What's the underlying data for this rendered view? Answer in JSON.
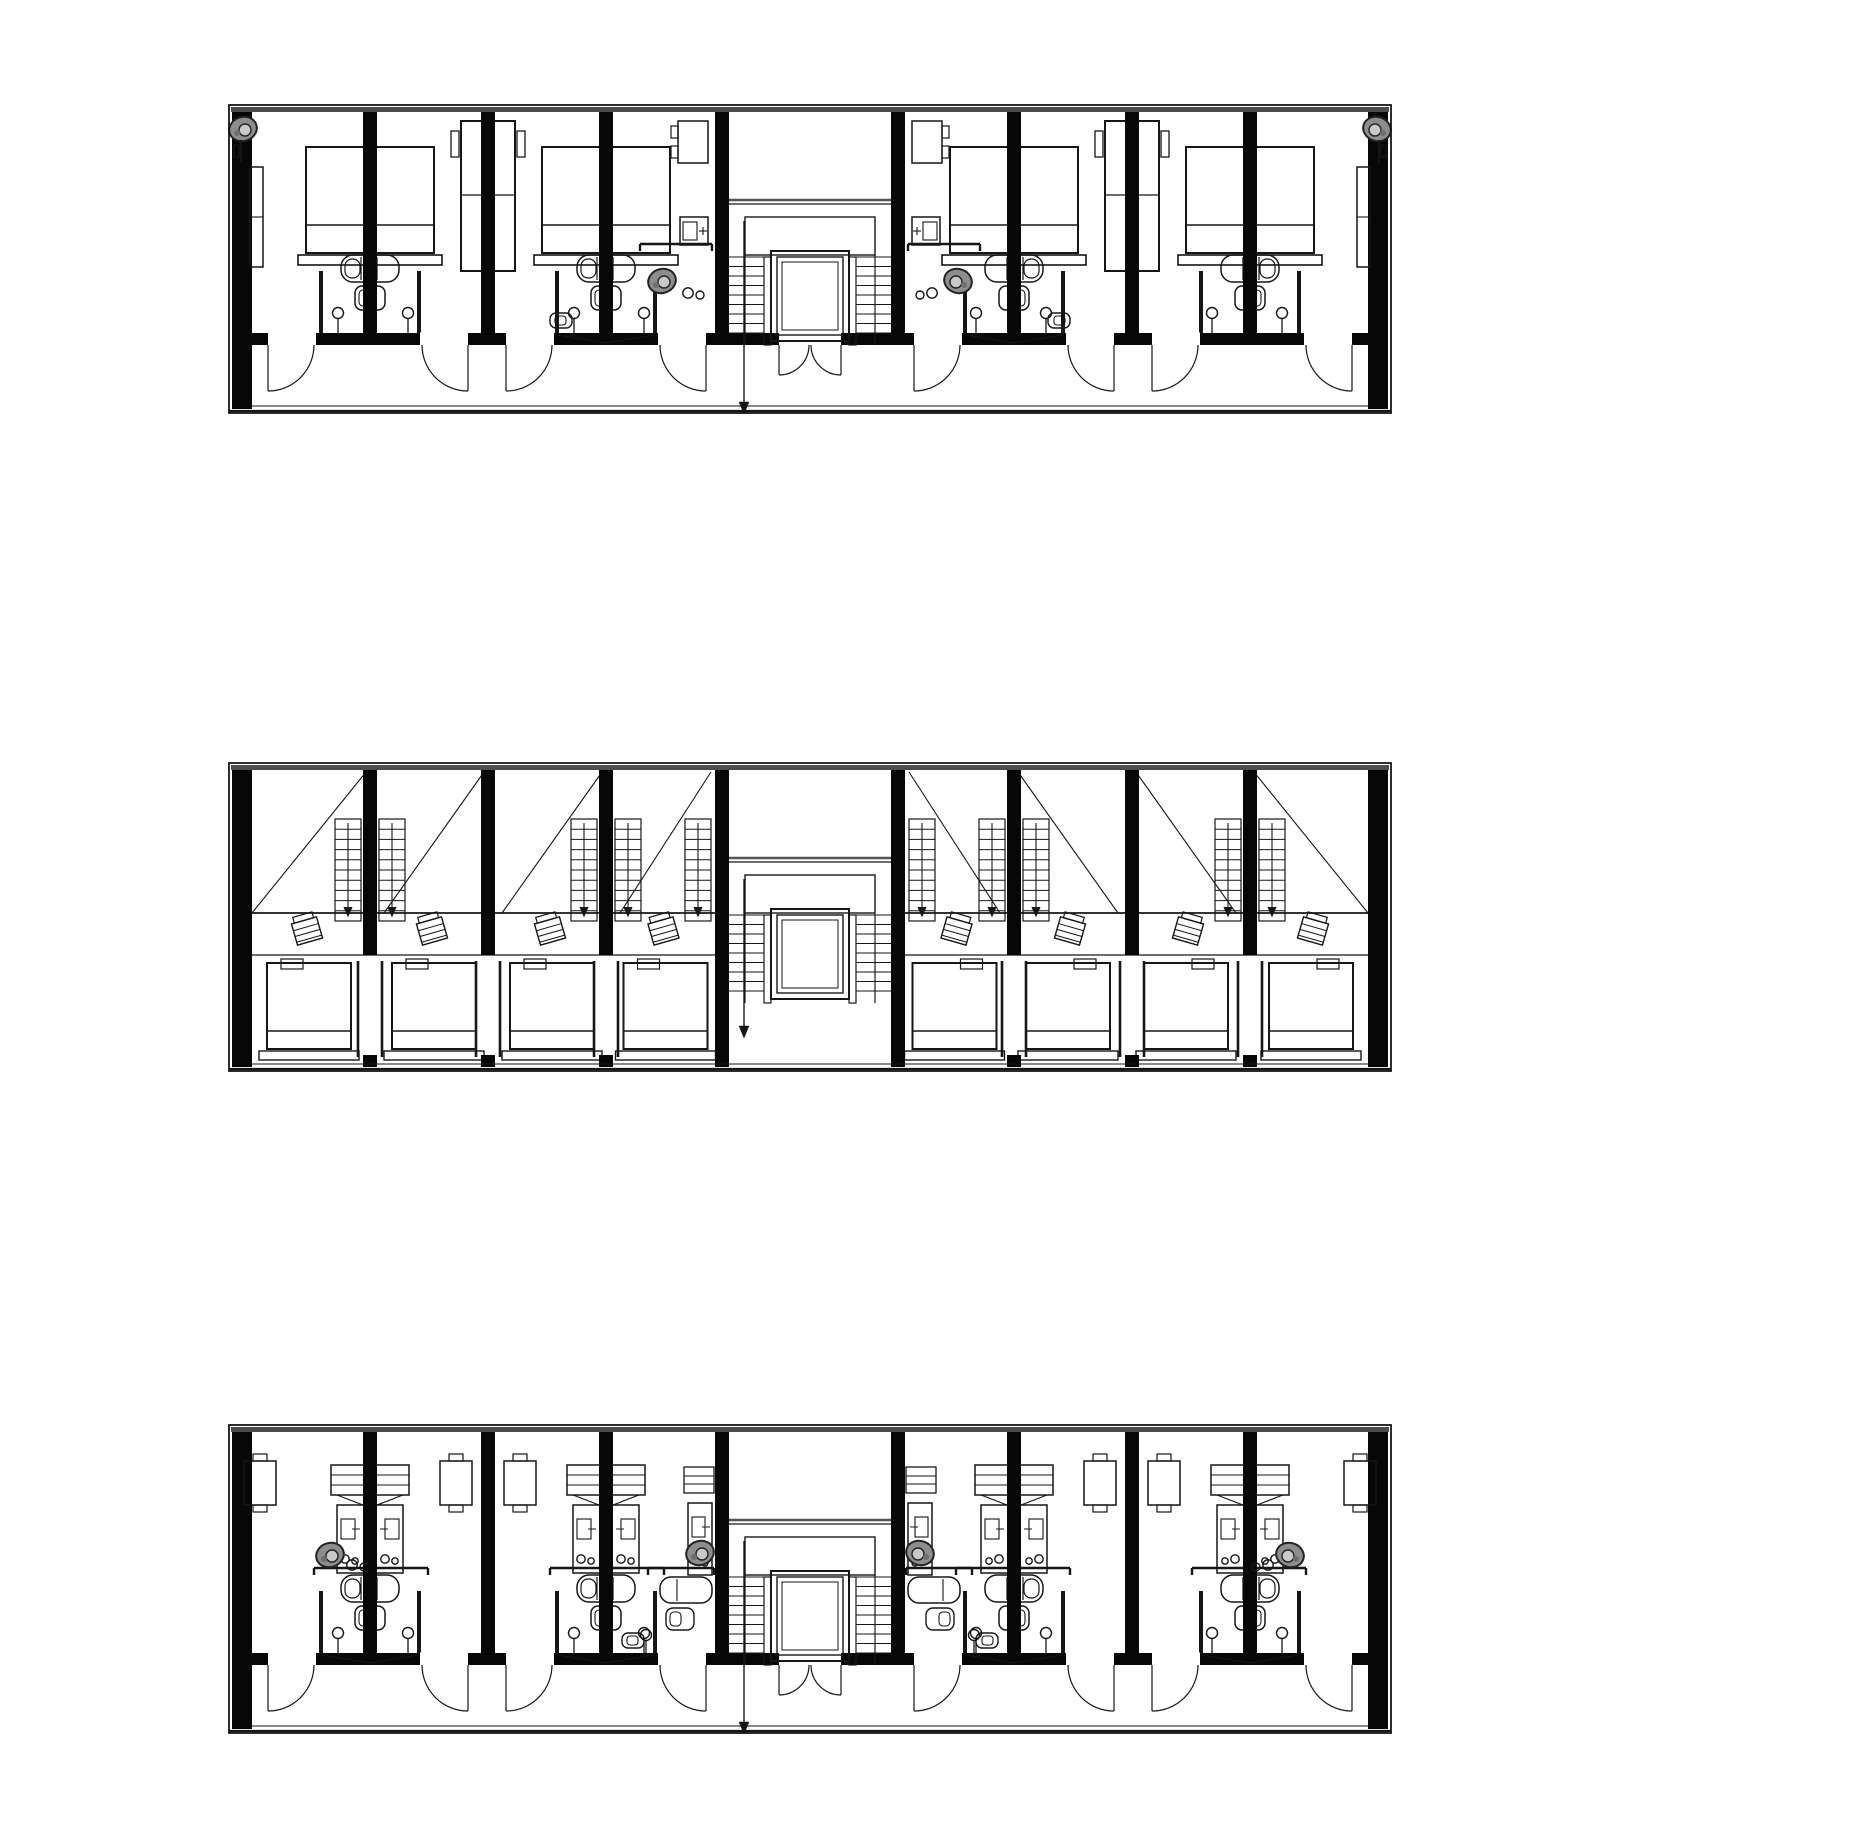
{
  "document": {
    "kind": "architectural-floor-plan-sheet",
    "description": "Three stacked floor plans of a long slab residential/hostel building with a central stair and elevator core",
    "background": "#ffffff"
  },
  "palette": {
    "ink": "#161616",
    "wall_fill": "#070707",
    "facade_gray": "#4d4d4d",
    "landing_gray": "#555555",
    "fixture_gray": "#8d8d8d",
    "fixture_gray_light": "#c9c9c9"
  },
  "canvas": {
    "width": 1862,
    "height": 1848
  },
  "building": {
    "x_left": 229,
    "x_right": 1391,
    "mirror_axis": 810,
    "strip_height": 308,
    "end_wall": {
      "x": 232,
      "w": 20
    },
    "interior_wall_t": 14,
    "core": {
      "wall_left_x": 715,
      "wall_right_x": 891,
      "wall_t": 14
    }
  },
  "core_detail": {
    "landing_y": 95,
    "stairwell_rect": {
      "x": 745,
      "y": 112,
      "w": 130,
      "h": 38
    },
    "tread_top": 152,
    "tread_bottom": 228,
    "tread_count": 9,
    "flight_left": [
      729,
      764
    ],
    "flight_right": [
      856,
      891
    ],
    "jamb_left": {
      "x": 764,
      "w": 7
    },
    "jamb_right": {
      "x": 849,
      "w": 7
    },
    "elevator": {
      "x": 771,
      "y": 146,
      "w": 78,
      "h": 90,
      "inset1": 6,
      "inset2": 11
    },
    "arrow_x": 744,
    "entrance": {
      "left_hinge": 779,
      "right_hinge": 841,
      "radius": 30,
      "open_from": 779,
      "open_to": 841
    }
  },
  "plans": [
    {
      "id": "floor-plan-upper-rooms",
      "kind": "rooms",
      "top": 105,
      "corridor_y": 228,
      "corridor_t": 12,
      "walls": [
        370,
        488,
        606
      ],
      "bays": [
        {
          "wall": 370,
          "bed": "double-pair",
          "pod": true,
          "toilet": false,
          "xmark": false
        },
        {
          "wall": 488,
          "bed": "twin-vertical",
          "pod": false,
          "toilet": false,
          "xmark": false
        },
        {
          "wall": 606,
          "bed": "double-pair",
          "pod": true,
          "toilet": true,
          "xmark": true
        }
      ],
      "door_openings": [
        {
          "hinge": 268,
          "dir": 1
        },
        {
          "hinge": 468,
          "dir": -1
        },
        {
          "hinge": 506,
          "dir": 1
        },
        {
          "hinge": 706,
          "dir": -1
        }
      ],
      "door_radius": 46,
      "fixtures": [
        [
          "shower-blob",
          243,
          24,
          1
        ],
        [
          "wardrobe",
          250,
          62
        ],
        [
          "desk-chair",
          678,
          16
        ],
        [
          "cabinet",
          680,
          112
        ],
        [
          "shower-blob",
          662,
          176,
          0
        ],
        [
          "dot-pair",
          688,
          188
        ],
        [
          "rail",
          640,
          712,
          139
        ]
      ]
    },
    {
      "id": "floor-plan-loft-level",
      "kind": "loft",
      "top": 763,
      "walls": [
        370,
        488,
        606
      ],
      "modules": [
        [
          252,
          366
        ],
        [
          384,
          484
        ],
        [
          502,
          602
        ],
        [
          620,
          711
        ]
      ],
      "stair_pair_walls": [
        370,
        606
      ],
      "single_stair_x": 685,
      "walkway_y1": 150,
      "walkway_y2": 192,
      "bed_y": 200,
      "bed_w": 84,
      "bed_h": 86,
      "glass_offset": 12
    },
    {
      "id": "floor-plan-lower-rooms",
      "kind": "compact",
      "top": 1425,
      "corridor_y": 228,
      "corridor_t": 12,
      "walls": [
        370,
        488,
        606
      ],
      "bays": [
        {
          "wall": 370,
          "unit": "locker-bath",
          "pod": true,
          "xmark": true
        },
        {
          "wall": 488,
          "unit": "tables",
          "pod": false,
          "xmark": false
        },
        {
          "wall": 606,
          "unit": "locker-bath",
          "pod": true,
          "xmark": true
        }
      ],
      "door_openings": [
        {
          "hinge": 268,
          "dir": 1
        },
        {
          "hinge": 468,
          "dir": -1
        },
        {
          "hinge": 506,
          "dir": 1
        },
        {
          "hinge": 706,
          "dir": -1
        }
      ],
      "door_radius": 46,
      "fixtures": [
        [
          "table",
          244,
          36
        ],
        [
          "shower-blob",
          330,
          130,
          0
        ],
        [
          "dot-pair",
          352,
          140
        ],
        [
          "shelf-stack",
          684,
          42
        ],
        [
          "locker",
          688,
          78
        ],
        [
          "rail",
          648,
          714,
          143
        ],
        [
          "tub-v",
          660,
          152
        ],
        [
          "sink",
          666,
          183
        ],
        [
          "sconce",
          646,
          210
        ],
        [
          "toilet",
          622,
          208
        ],
        [
          "shower-blob",
          700,
          128,
          0
        ]
      ]
    }
  ]
}
